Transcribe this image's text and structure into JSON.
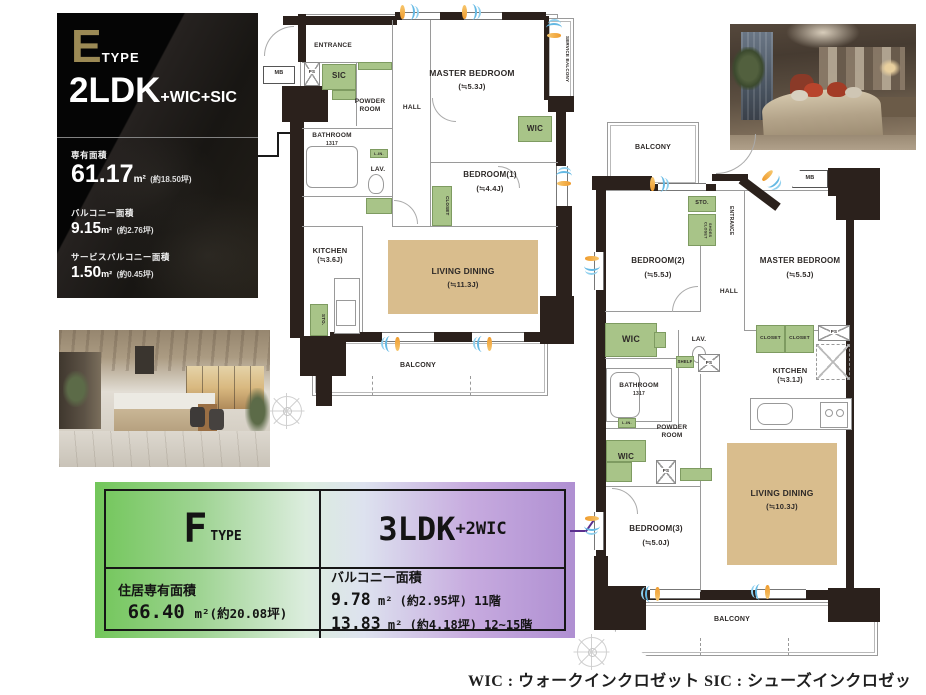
{
  "e_panel": {
    "type_letter": "E",
    "type_word": "TYPE",
    "layout_main": "2LDK",
    "layout_suffix": "+WIC+SIC",
    "areas": [
      {
        "label": "専有面積",
        "value": "61.17",
        "unit": "m²",
        "tsubo": "(約18.50坪)"
      },
      {
        "label": "バルコニー面積",
        "value": "9.15",
        "unit": "m²",
        "tsubo": "(約2.76坪)"
      },
      {
        "label": "サービスバルコニー面積",
        "value": "1.50",
        "unit": "m²",
        "tsubo": "(約0.45坪)"
      }
    ]
  },
  "f_panel": {
    "type_letter": "F",
    "type_word": "TYPE",
    "layout_main": "3LDK",
    "layout_suffix": "+2WIC",
    "area_label": "住居専有面積",
    "area_value": "66.40",
    "area_unit": "m²",
    "area_tsubo": "(約20.08坪)",
    "balcony_label": "バルコニー面積",
    "balcony_rows": [
      {
        "value": "9.78",
        "unit": "m²",
        "rest": "(約2.95坪) 11階"
      },
      {
        "value": "13.83",
        "unit": "m²",
        "rest": "(約4.18坪) 12~15階"
      }
    ]
  },
  "plan_e": {
    "entrance": "ENTRANCE",
    "mb": "MB",
    "ps": "PS",
    "sic": "SIC",
    "powder_room": "POWDER ROOM",
    "hall": "HALL",
    "bathroom": "BATHROOM",
    "bathroom_size": "1317",
    "lin": "L.IN.",
    "lav": "LAV.",
    "kitchen": "KITCHEN",
    "kitchen_size": "(≒3.6J)",
    "master_bedroom": "MASTER BEDROOM",
    "master_bedroom_size": "(≒5.3J)",
    "wic": "WIC",
    "bedroom1": "BEDROOM(1)",
    "bedroom1_size": "(≒4.4J)",
    "closet": "CLOSET",
    "sto": "STO.",
    "living_dining": "LIVING DINING",
    "living_dining_size": "(≒11.3J)",
    "balcony": "BALCONY",
    "service_balcony": "SERVICE BALCONY"
  },
  "plan_f": {
    "balcony_top": "BALCONY",
    "sto": "STO.",
    "shoes_closet": "SHOES CLOSET",
    "entrance": "ENTRANCE",
    "mb": "MB",
    "bedroom2": "BEDROOM(2)",
    "bedroom2_size": "(≒5.5J)",
    "master_bedroom": "MASTER BEDROOM",
    "master_bedroom_size": "(≒5.5J)",
    "hall": "HALL",
    "wic": "WIC",
    "lav": "LAV.",
    "shelf": "SHELF",
    "ps": "PS",
    "closet": "CLOSET",
    "kitchen": "KITCHEN",
    "kitchen_size": "(≒3.1J)",
    "bathroom": "BATHROOM",
    "bathroom_size": "1317",
    "lin": "L.IN.",
    "powder_room": "POWDER ROOM",
    "bedroom3": "BEDROOM(3)",
    "bedroom3_size": "(≒5.0J)",
    "living_dining": "LIVING DINING",
    "living_dining_size": "(≒10.3J)",
    "balcony_bottom": "BALCONY"
  },
  "footer": {
    "legend": "WIC : ウォークインクロゼット  SIC : シューズインクロゼット"
  },
  "colors": {
    "wall": "#2b211c",
    "fixture_green": "#a8c488",
    "living_tan": "#d9bd8d",
    "e_gold": "#9c8a55",
    "f_green": "#72c65a",
    "f_purple": "#af8fd2",
    "vent_blue": "#64b9e4",
    "vent_orange": "#ef9b2d",
    "callout_purple": "#5b2f8e"
  }
}
